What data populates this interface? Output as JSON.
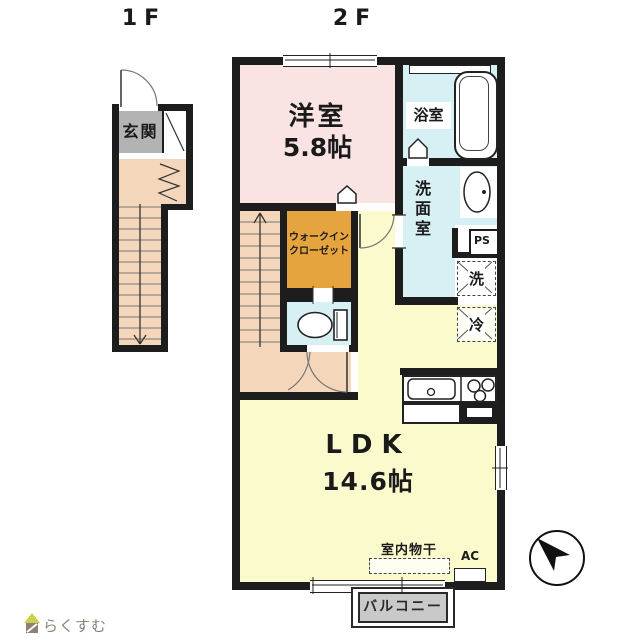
{
  "floor1": {
    "label": "1F",
    "genkan": "玄関"
  },
  "floor2": {
    "label": "2F",
    "western_room": {
      "name": "洋室",
      "size": "5.8帖"
    },
    "bath": "浴室",
    "washroom": "洗面室",
    "wic": {
      "line1": "ウォークイン",
      "line2": "クローゼット"
    },
    "ps": "PS",
    "washer": "洗",
    "fridge": "冷",
    "ldk": {
      "name": "LDK",
      "size": "14.6帖"
    },
    "indoor_drying": "室内物干",
    "ac": "AC",
    "balcony": "バルコニー"
  },
  "compass": {
    "points": "NW"
  },
  "footer": {
    "logo_text": "らくすむ"
  },
  "colors": {
    "wall": "#1d1d1d",
    "western_room": "#f9e3e3",
    "wet_rooms": "#d7f0f4",
    "wic": "#e6a43e",
    "ldk": "#fbfacd",
    "stairs_hall": "#f4d6ba",
    "genkan": "#b3b3b3",
    "balcony": "#c9c9c9",
    "logo_green": "#c7d24e",
    "logo_gray": "#8b8178"
  }
}
